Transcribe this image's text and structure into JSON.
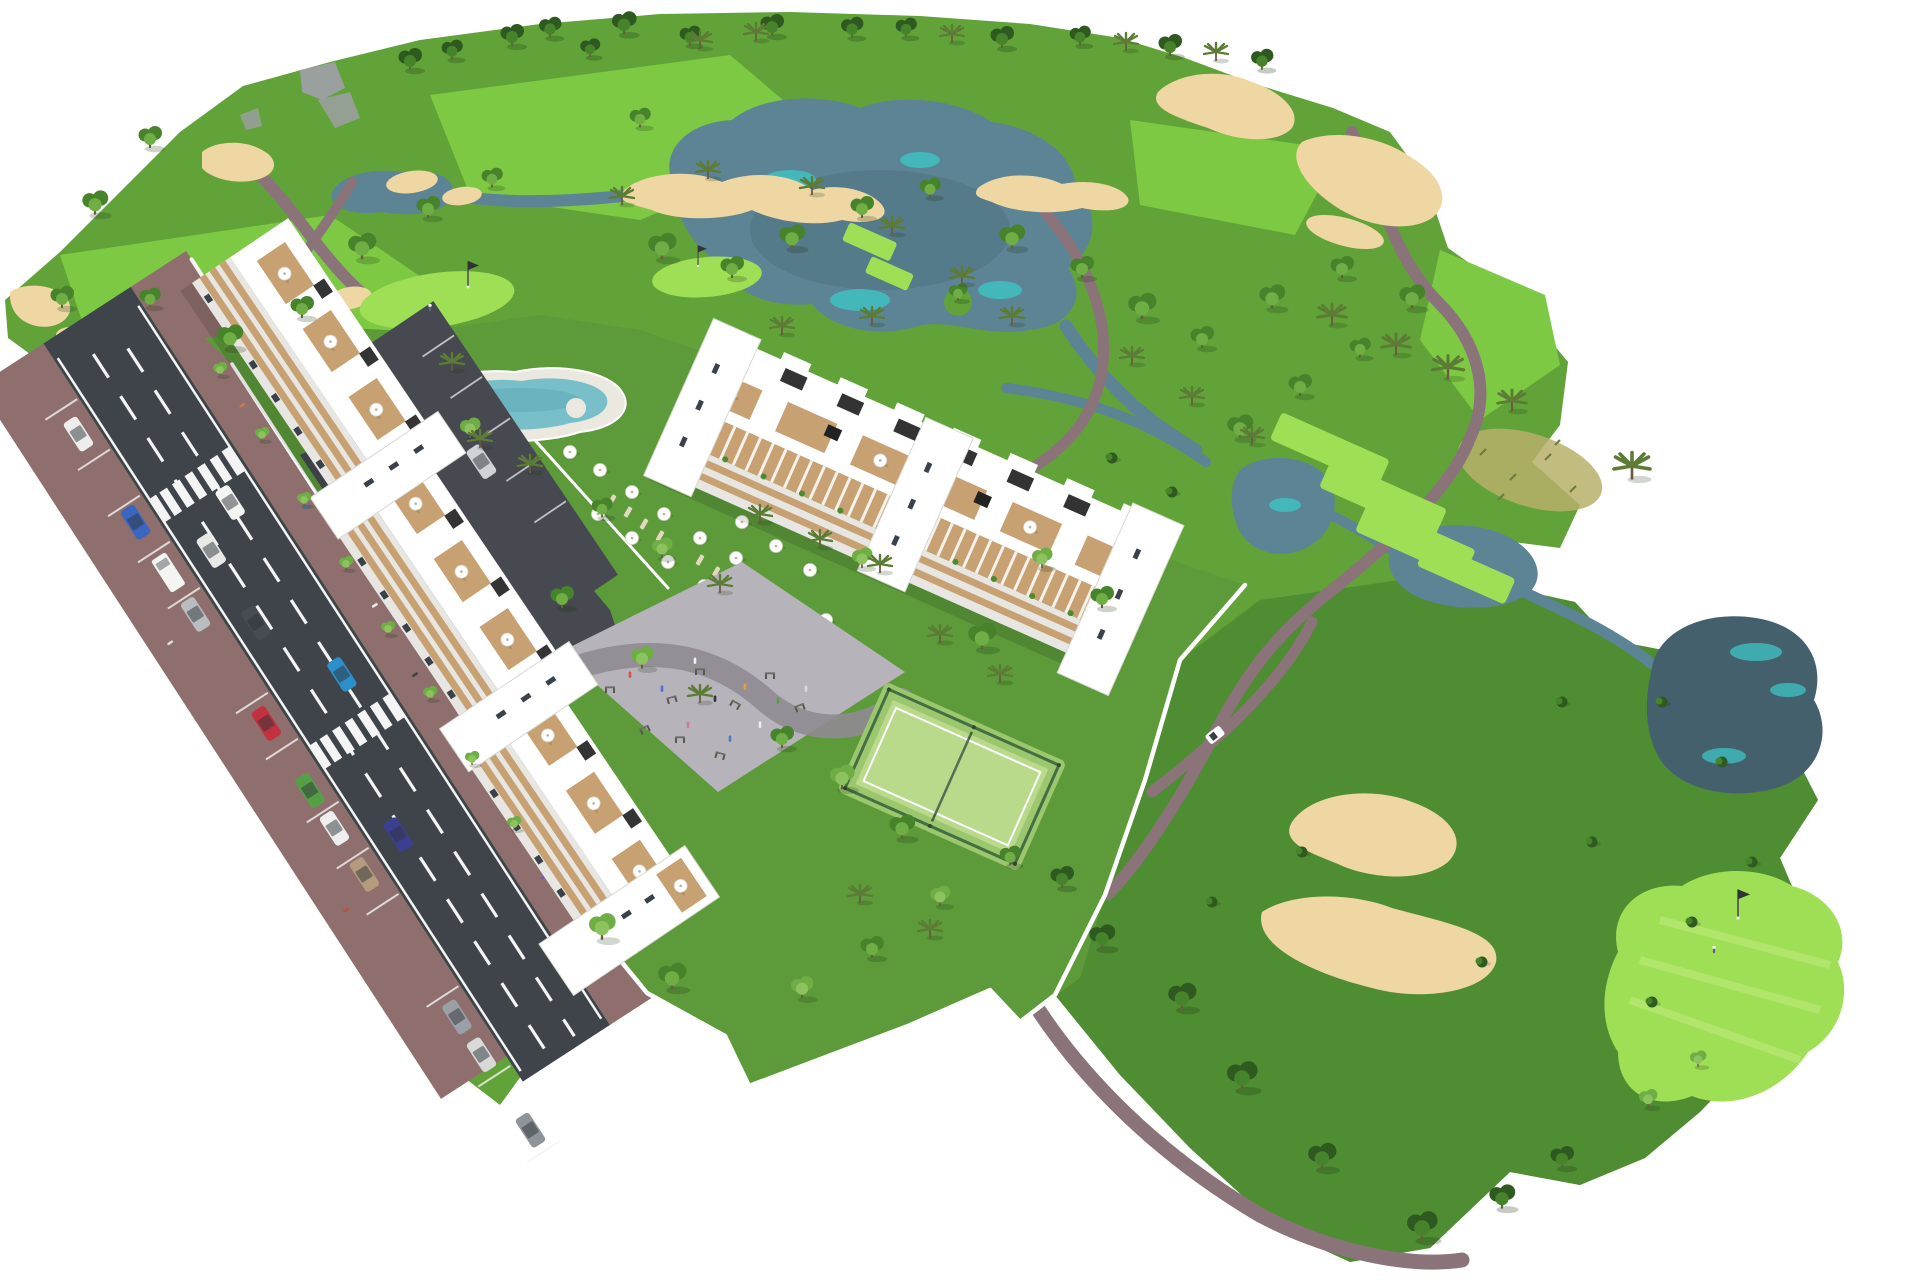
{
  "meta": {
    "render_type": "3D architectural aerial masterplan render",
    "subject": "Golf resort apartment development surrounded by golf course, lakes and amenities",
    "view": "isometric aerial",
    "background": "white",
    "visible_text": "none"
  },
  "palette": {
    "bg": "#ffffff",
    "green_dark": "#4c8a31",
    "green_mid": "#61a339",
    "green_lawn": "#5d9a3a",
    "green_fairway": "#7ec944",
    "green_tee": "#9fdf55",
    "tree_dark": "#2e5a20",
    "tree_mid": "#47832b",
    "tree_light": "#6fae44",
    "palm_green": "#5c7c35",
    "trunk": "#6b5b3f",
    "water_dark": "#44606d",
    "water_mid": "#5d8494",
    "water_teal": "#3ec4c4",
    "sand": "#eed7a3",
    "path_mauve": "#8a7379",
    "road_dark": "#3f434a",
    "road_line": "#f4f4f4",
    "sidewalk_mauve": "#8e6f6d",
    "asphalt_lot": "#46494f",
    "building_white": "#ffffff",
    "building_shade": "#e7e6e2",
    "wood_tan": "#c7a172",
    "window_dark": "#39424a",
    "pool_water": "#78bfca",
    "pool_deck": "#ebe8df",
    "court_green": "#b8da8a",
    "fence_green": "#39663c",
    "plaza_gray": "#b7b3ba",
    "plaza_path": "#908b94",
    "rock_gray": "#9aa09e",
    "dry_grass": "#b7b06b",
    "flag_dark": "#333333"
  },
  "scene": {
    "golf_course": {
      "lakes": [
        {
          "name": "main-lake"
        },
        {
          "name": "west-pond"
        },
        {
          "name": "mid-ponds",
          "count": 2
        },
        {
          "name": "southeast-pond"
        }
      ],
      "streams": 4,
      "bunkers_approx": 14,
      "putting_greens": [
        {
          "name": "green-by-pool",
          "flag": true,
          "golfer": true
        },
        {
          "name": "small-green-north",
          "flag": true,
          "golfer": false
        },
        {
          "name": "green-southeast",
          "flag": true,
          "golfer": true
        }
      ],
      "tee_boxes": 6,
      "cart_paths": "winding mauve paths",
      "golf_cart": {
        "color": "#ffffff"
      },
      "rock_outcrops": 3,
      "dry_grass_patch": 1
    },
    "road": {
      "name": "access-road",
      "lanes": 2,
      "lane_marking": "white dashed",
      "edge_lines": true,
      "crosswalks": 2,
      "parking_bays": true,
      "pedestrians_approx": 10,
      "cars": [
        {
          "id": "parked-1",
          "color": "#ededed",
          "state": "parked"
        },
        {
          "id": "parked-2",
          "color": "#3a66c0",
          "state": "parked"
        },
        {
          "id": "parked-3",
          "color": "#f4f4f2",
          "state": "parked",
          "type": "van"
        },
        {
          "id": "parked-4",
          "color": "#b9bdc2",
          "state": "parked"
        },
        {
          "id": "parked-5",
          "color": "#c33040",
          "state": "parked"
        },
        {
          "id": "parked-6",
          "color": "#55a047",
          "state": "parked"
        },
        {
          "id": "parked-7",
          "color": "#eeeeee",
          "state": "parked"
        },
        {
          "id": "parked-8",
          "color": "#b49a7e",
          "state": "parked"
        },
        {
          "id": "parked-9",
          "color": "#9aa0a6",
          "state": "parked"
        },
        {
          "id": "parked-10",
          "color": "#d9d9d9",
          "state": "parked"
        },
        {
          "id": "parked-11",
          "color": "#8e9499",
          "state": "parked"
        },
        {
          "id": "driving-1",
          "color": "#f4f4f2",
          "state": "driving"
        },
        {
          "id": "driving-2",
          "color": "#e8e8e6",
          "state": "driving"
        },
        {
          "id": "driving-3",
          "color": "#2d8fc9",
          "state": "driving"
        },
        {
          "id": "driving-4",
          "color": "#3c3f8f",
          "state": "driving"
        },
        {
          "id": "driving-5",
          "color": "#474b52",
          "state": "driving"
        },
        {
          "id": "lot-1",
          "color": "#cfd2d6",
          "state": "parked"
        }
      ]
    },
    "buildings": [
      {
        "id": "block-a",
        "description": "Long white 4-5 storey apartment block along the road",
        "storeys_visible": 5,
        "sections": 3,
        "features": [
          "beige balcony bands",
          "rooftop terraces with wood decks",
          "white parasols",
          "dark solar panels",
          "stair towers"
        ]
      },
      {
        "id": "block-b",
        "description": "Long white terraced apartment block facing the golf course",
        "storeys_visible": 4,
        "sections": 3,
        "features": [
          "wood pergolas",
          "rooftop terraces",
          "solar panels",
          "stair towers"
        ]
      }
    ],
    "amenities": {
      "pool": {
        "type": "lagoon swimming pool",
        "water_color": "#78bfca",
        "parasols": 16,
        "sun_loungers_approx": 16
      },
      "padel_court": {
        "count": 1,
        "surface_color": "#b8da8a",
        "fenced": true
      },
      "playground": {
        "description": "grey paved play / calisthenics plaza with curved path",
        "equipment_pieces_approx": 10,
        "people_present": true
      },
      "service_parking": {
        "surface": "dark asphalt"
      },
      "private_gardens": {
        "boundary": "white walls"
      }
    },
    "vegetation": {
      "canopy_trees_approx": 60,
      "palm_trees_approx": 30,
      "bushes_approx": 12,
      "horizon_tree_line": true
    }
  }
}
